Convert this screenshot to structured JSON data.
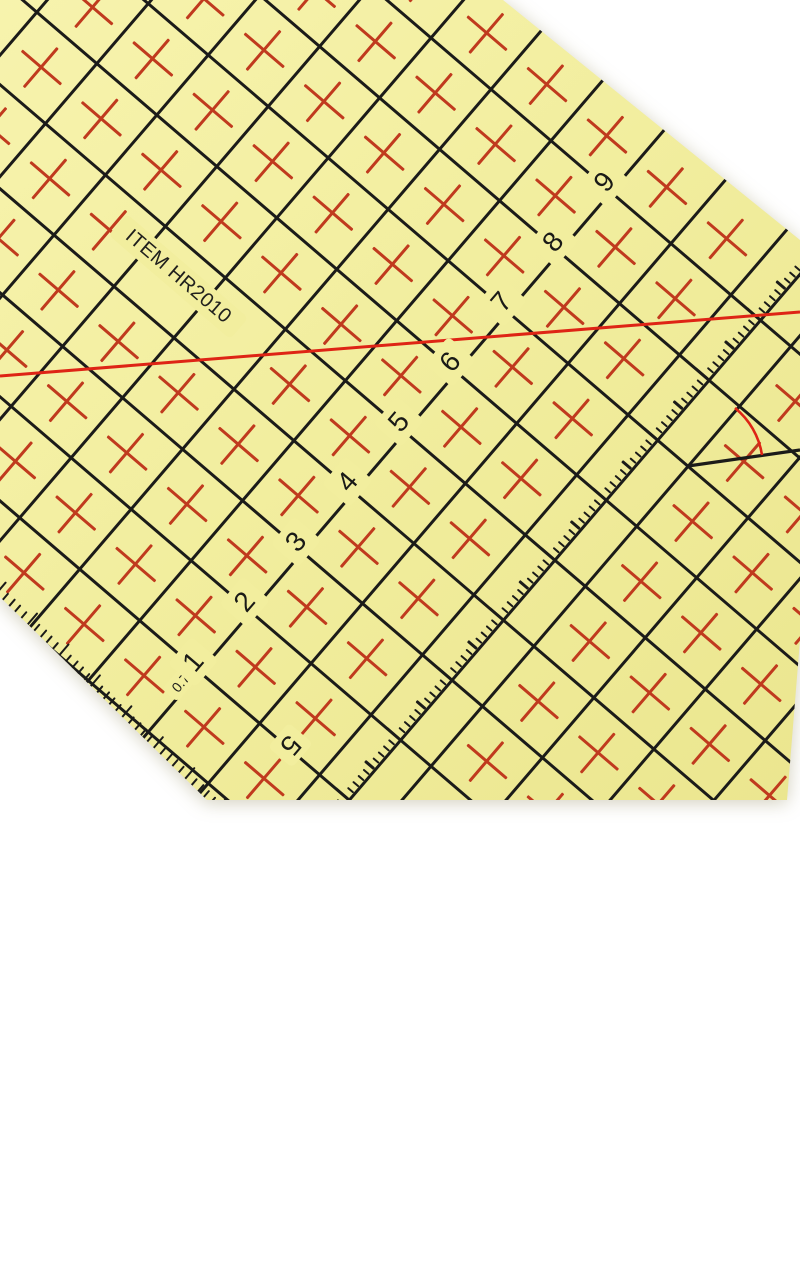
{
  "photo": {
    "background_color": "#ffffff",
    "description": "yellow quilting patchwork ruler photographed at an angle on white background"
  },
  "ruler": {
    "item_label": "ITEM HR2010",
    "diagonal_scale_numbers": [
      "9",
      "8",
      "7",
      "6",
      "5",
      "4",
      "3",
      "2",
      "1"
    ],
    "seam_allowance_label": "0.7",
    "bottom_scale_number": "5",
    "colors": {
      "surface_yellow": "#f2ee9f",
      "halo_yellow": "#f2ee9e",
      "grid_black": "#1b1b19",
      "cross_red": "#c03a1e",
      "bias_red": "#de2415"
    }
  }
}
